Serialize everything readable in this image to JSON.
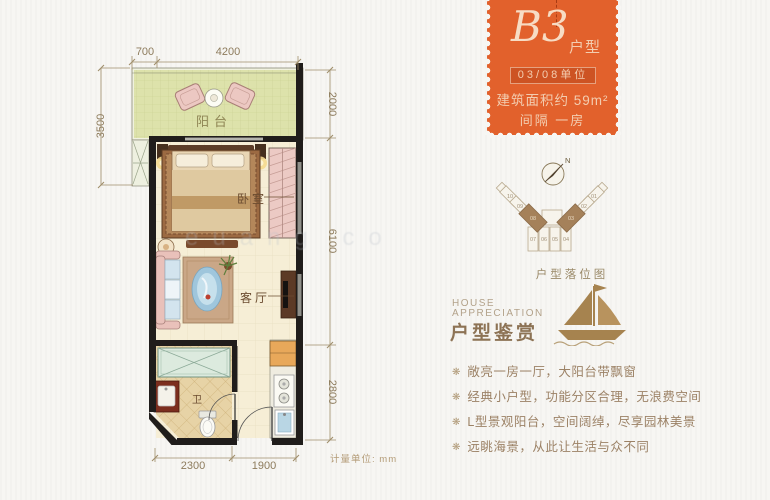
{
  "colors": {
    "accent_orange": "#e2612c",
    "text_brown": "#8d7355",
    "highlight_brown": "#a5815a"
  },
  "stamp": {
    "code": "B3",
    "code_suffix": "户型",
    "unit_line": "03/08单位",
    "area_line": "建筑面积约 59m²",
    "layout_line": "间隔 一房"
  },
  "floorplan": {
    "labels": {
      "balcony": "阳台",
      "bedroom": "卧室",
      "living": "客厅",
      "bath": "卫"
    },
    "dims": {
      "top_left": "700",
      "top_main": "4200",
      "left": "3500",
      "right_top": "2000",
      "right_mid": "6100",
      "right_bottom": "2800",
      "bottom_left": "2300",
      "bottom_right": "1900"
    },
    "unit_note": "计量单位: mm",
    "watermark": "euang co"
  },
  "locator": {
    "compass": "N",
    "title": "户型落位图",
    "units_center": [
      "07",
      "06",
      "05",
      "04"
    ],
    "units_left": [
      "10",
      "09",
      "08"
    ],
    "units_right": [
      "01",
      "02",
      "03"
    ]
  },
  "appreciation": {
    "en1": "HOUSE",
    "en2": "APPRECIATION",
    "cn": "户型鉴赏",
    "bullet_icon": "❋",
    "bullets": [
      "敞亮一房一厅，大阳台带飘窗",
      "经典小户型，功能分区合理，无浪费空间",
      "L型景观阳台，空间阔绰，尽享园林美景",
      "远眺海景，从此让生活与众不同"
    ]
  }
}
